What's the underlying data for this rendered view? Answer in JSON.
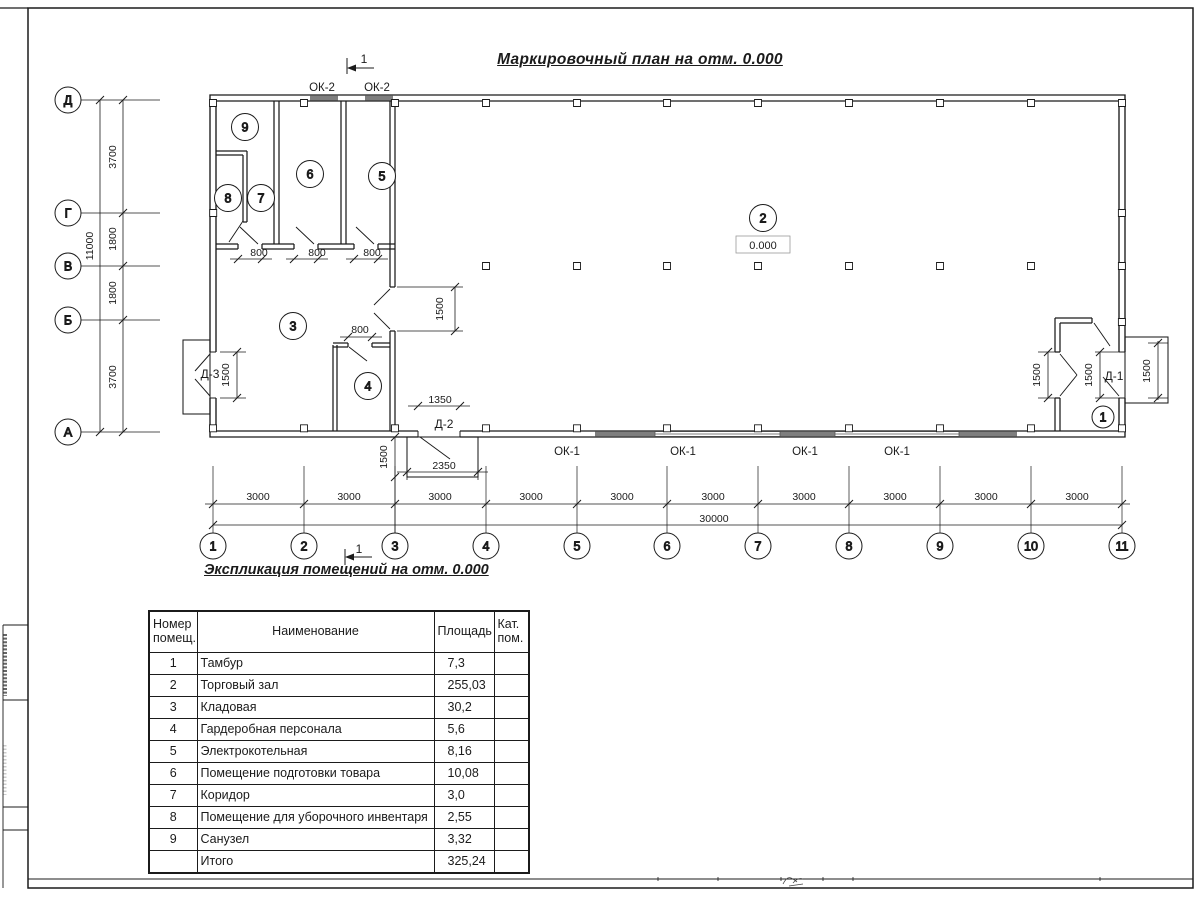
{
  "page": {
    "title": "Маркировочный план на отм. 0.000",
    "table_title": "Экспликация помещений на отм. 0.000"
  },
  "plan": {
    "axis_rows": [
      {
        "label": "Д",
        "y": 100
      },
      {
        "label": "Г",
        "y": 213
      },
      {
        "label": "В",
        "y": 266
      },
      {
        "label": "Б",
        "y": 320
      },
      {
        "label": "А",
        "y": 432
      }
    ],
    "axis_cols": [
      {
        "label": "1",
        "x": 213
      },
      {
        "label": "2",
        "x": 304
      },
      {
        "label": "3",
        "x": 395
      },
      {
        "label": "4",
        "x": 486
      },
      {
        "label": "5",
        "x": 577
      },
      {
        "label": "6",
        "x": 667
      },
      {
        "label": "7",
        "x": 758
      },
      {
        "label": "8",
        "x": 849
      },
      {
        "label": "9",
        "x": 940
      },
      {
        "label": "10",
        "x": 1031
      },
      {
        "label": "11",
        "x": 1122
      }
    ],
    "rooms": [
      {
        "num": "9",
        "x": 245,
        "y": 127
      },
      {
        "num": "8",
        "x": 228,
        "y": 198
      },
      {
        "num": "7",
        "x": 261,
        "y": 198
      },
      {
        "num": "6",
        "x": 310,
        "y": 174
      },
      {
        "num": "5",
        "x": 382,
        "y": 176
      },
      {
        "num": "3",
        "x": 293,
        "y": 326
      },
      {
        "num": "4",
        "x": 368,
        "y": 386
      },
      {
        "num": "2",
        "x": 763,
        "y": 218
      },
      {
        "num": "1",
        "x": 1103,
        "y": 417,
        "r": 11
      }
    ],
    "labels": [
      {
        "name": "dim-3700-top",
        "text": "3700",
        "x": 116,
        "y": 157,
        "rot": -90
      },
      {
        "name": "dim-1800-upper",
        "text": "1800",
        "x": 116,
        "y": 239,
        "rot": -90
      },
      {
        "name": "dim-1800-lower",
        "text": "1800",
        "x": 116,
        "y": 293,
        "rot": -90
      },
      {
        "name": "dim-3700-bottom",
        "text": "3700",
        "x": 116,
        "y": 377,
        "rot": -90
      },
      {
        "name": "dim-11000",
        "text": "11000",
        "x": 93,
        "y": 246,
        "rot": -90
      },
      {
        "name": "dim-3000-1",
        "text": "3000",
        "x": 258,
        "y": 500
      },
      {
        "name": "dim-3000-2",
        "text": "3000",
        "x": 349,
        "y": 500
      },
      {
        "name": "dim-3000-3",
        "text": "3000",
        "x": 440,
        "y": 500
      },
      {
        "name": "dim-3000-4",
        "text": "3000",
        "x": 531,
        "y": 500
      },
      {
        "name": "dim-3000-5",
        "text": "3000",
        "x": 622,
        "y": 500
      },
      {
        "name": "dim-3000-6",
        "text": "3000",
        "x": 713,
        "y": 500
      },
      {
        "name": "dim-3000-7",
        "text": "3000",
        "x": 804,
        "y": 500
      },
      {
        "name": "dim-3000-8",
        "text": "3000",
        "x": 895,
        "y": 500
      },
      {
        "name": "dim-3000-9",
        "text": "3000",
        "x": 986,
        "y": 500
      },
      {
        "name": "dim-3000-10",
        "text": "3000",
        "x": 1077,
        "y": 500
      },
      {
        "name": "dim-30000",
        "text": "30000",
        "x": 714,
        "y": 522
      },
      {
        "name": "dim-800-1",
        "text": "800",
        "x": 259,
        "y": 256
      },
      {
        "name": "dim-800-2",
        "text": "800",
        "x": 317,
        "y": 256
      },
      {
        "name": "dim-800-3",
        "text": "800",
        "x": 372,
        "y": 256
      },
      {
        "name": "dim-800-4",
        "text": "800",
        "x": 360,
        "y": 333
      },
      {
        "name": "dim-1350",
        "text": "1350",
        "x": 440,
        "y": 403
      },
      {
        "name": "dim-2350",
        "text": "2350",
        "x": 444,
        "y": 469
      },
      {
        "name": "dim-1500-hall-door",
        "text": "1500",
        "x": 443,
        "y": 309,
        "rot": -90
      },
      {
        "name": "dim-1500-d3",
        "text": "1500",
        "x": 229,
        "y": 375,
        "rot": -90
      },
      {
        "name": "dim-1500-d2",
        "text": "1500",
        "x": 387,
        "y": 457,
        "rot": -90
      },
      {
        "name": "dim-1500-tambour",
        "text": "1500",
        "x": 1040,
        "y": 375,
        "rot": -90
      },
      {
        "name": "dim-1500-d1",
        "text": "1500",
        "x": 1092,
        "y": 375,
        "rot": -90
      },
      {
        "name": "dim-1500-porch",
        "text": "1500",
        "x": 1150,
        "y": 371,
        "rot": -90
      },
      {
        "name": "window-label-ok2-1",
        "text": "ОК-2",
        "x": 322,
        "y": 91,
        "fs": 11.5
      },
      {
        "name": "window-label-ok2-2",
        "text": "ОК-2",
        "x": 377,
        "y": 91,
        "fs": 11.5
      },
      {
        "name": "window-label-ok1-1",
        "text": "ОК-1",
        "x": 567,
        "y": 455,
        "fs": 11.5
      },
      {
        "name": "window-label-ok1-2",
        "text": "ОК-1",
        "x": 683,
        "y": 455,
        "fs": 11.5
      },
      {
        "name": "window-label-ok1-3",
        "text": "ОК-1",
        "x": 805,
        "y": 455,
        "fs": 11.5
      },
      {
        "name": "window-label-ok1-4",
        "text": "ОК-1",
        "x": 897,
        "y": 455,
        "fs": 11.5
      },
      {
        "name": "door-label-d3",
        "text": "Д-3",
        "x": 210,
        "y": 378,
        "fs": 12
      },
      {
        "name": "door-label-d2",
        "text": "Д-2",
        "x": 444,
        "y": 428,
        "fs": 12
      },
      {
        "name": "door-label-d1",
        "text": "Д-1",
        "x": 1114,
        "y": 380,
        "fs": 12
      },
      {
        "name": "level-mark",
        "text": "0.000",
        "x": 763,
        "y": 249,
        "fs": 11
      },
      {
        "name": "section-mark-top",
        "text": "1",
        "x": 364,
        "y": 63,
        "fs": 12
      },
      {
        "name": "section-mark-bottom",
        "text": "1",
        "x": 359,
        "y": 553,
        "fs": 12
      }
    ]
  },
  "table": {
    "headers": [
      "Номер\nпомещ.",
      "Наименование",
      "Площадь",
      "Кат.\nпом."
    ],
    "rows": [
      {
        "num": "1",
        "name": "Тамбур",
        "area": "7,3",
        "cat": ""
      },
      {
        "num": "2",
        "name": "Торговый зал",
        "area": "255,03",
        "cat": ""
      },
      {
        "num": "3",
        "name": "Кладовая",
        "area": "30,2",
        "cat": ""
      },
      {
        "num": "4",
        "name": "Гардеробная персонала",
        "area": "5,6",
        "cat": ""
      },
      {
        "num": "5",
        "name": "Электрокотельная",
        "area": "8,16",
        "cat": ""
      },
      {
        "num": "6",
        "name": "Помещение подготовки товара",
        "area": "10,08",
        "cat": ""
      },
      {
        "num": "7",
        "name": "Коридор",
        "area": "3,0",
        "cat": ""
      },
      {
        "num": "8",
        "name": "Помещение для уборочного инвентаря",
        "area": "2,55",
        "cat": ""
      },
      {
        "num": "9",
        "name": "Санузел",
        "area": "3,32",
        "cat": ""
      },
      {
        "num": "",
        "name": "Итого",
        "area": "325,24",
        "cat": ""
      }
    ]
  }
}
